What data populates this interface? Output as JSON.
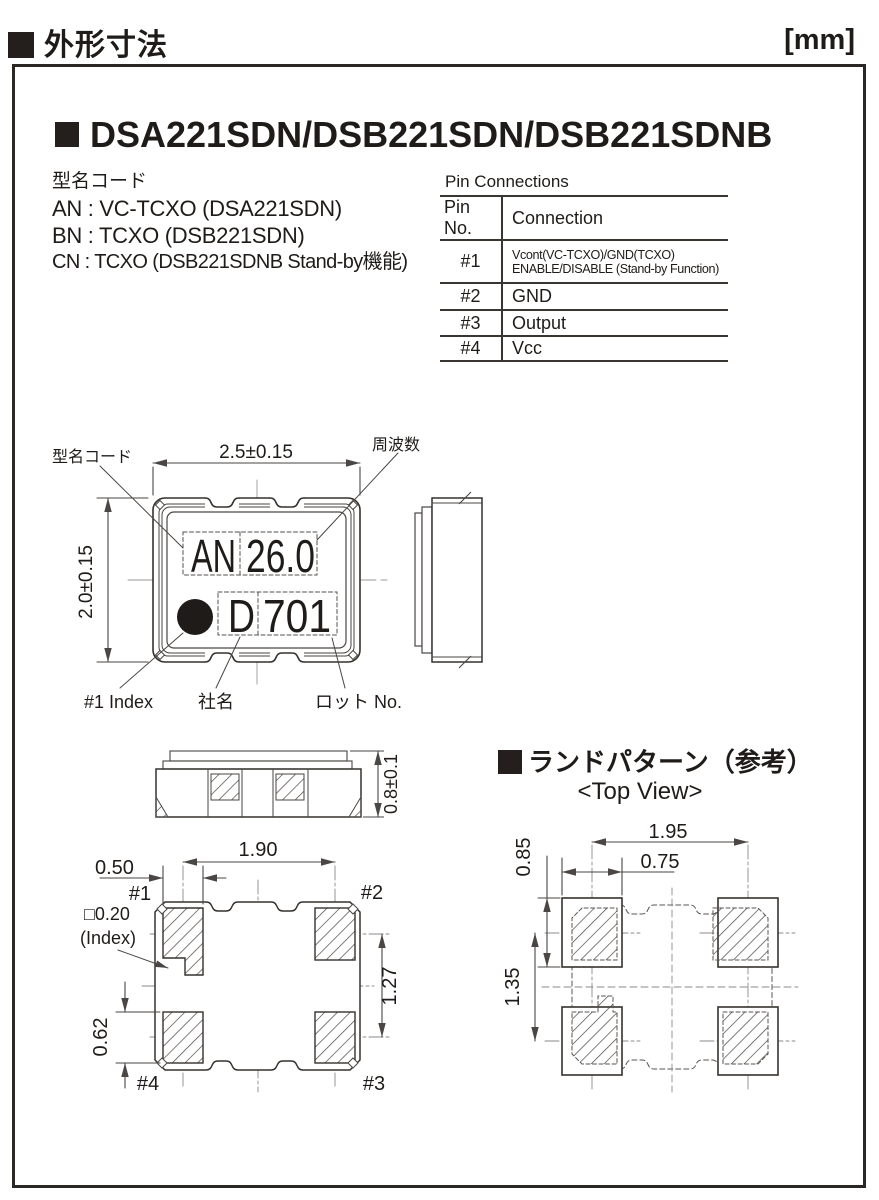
{
  "header": {
    "title": "外形寸法",
    "unit": "[mm]"
  },
  "product": {
    "title": "DSA221SDN/DSB221SDN/DSB221SDNB"
  },
  "model_codes": {
    "heading": "型名コード",
    "line_an": "AN : VC-TCXO (DSA221SDN)",
    "line_bn": "BN : TCXO (DSB221SDN)",
    "line_cn": "CN : TCXO (DSB221SDNB Stand-by機能)"
  },
  "pin_table": {
    "title": "Pin Connections",
    "col_pin": "Pin No.",
    "col_conn": "Connection",
    "rows": {
      "r1": {
        "pin": "#1",
        "line1": "Vcont(VC-TCXO)/GND(TCXO)",
        "line2": "ENABLE/DISABLE (Stand-by Function)"
      },
      "r2": {
        "pin": "#2",
        "conn": "GND"
      },
      "r3": {
        "pin": "#3",
        "conn": "Output"
      },
      "r4": {
        "pin": "#4",
        "conn": "Vcc"
      }
    }
  },
  "top_view": {
    "dim_width": "2.5±0.15",
    "dim_height": "2.0±0.15",
    "label_model_code": "型名コード",
    "label_frequency": "周波数",
    "marking": {
      "line1_left": "AN",
      "line1_right": "26.0",
      "line2_left": "D",
      "line2_right": "701"
    },
    "label_index": "#1 Index",
    "label_company": "社名",
    "label_lot": "ロット No."
  },
  "front_view": {
    "dim_height": "0.8±0.1"
  },
  "bottom_view": {
    "dim_pitch_h": "1.90",
    "dim_pad_w": "0.50",
    "index_size": "□0.20",
    "index_label": "(Index)",
    "dim_pitch_v": "1.27",
    "dim_pad_l": "0.62",
    "pin1": "#1",
    "pin2": "#2",
    "pin3": "#3",
    "pin4": "#4"
  },
  "land_pattern": {
    "title": "ランドパターン（参考）",
    "subtitle": "<Top View>",
    "dim_pitch_h": "1.95",
    "dim_pad_w": "0.75",
    "dim_pad_h": "0.85",
    "dim_pitch_v": "1.35"
  }
}
